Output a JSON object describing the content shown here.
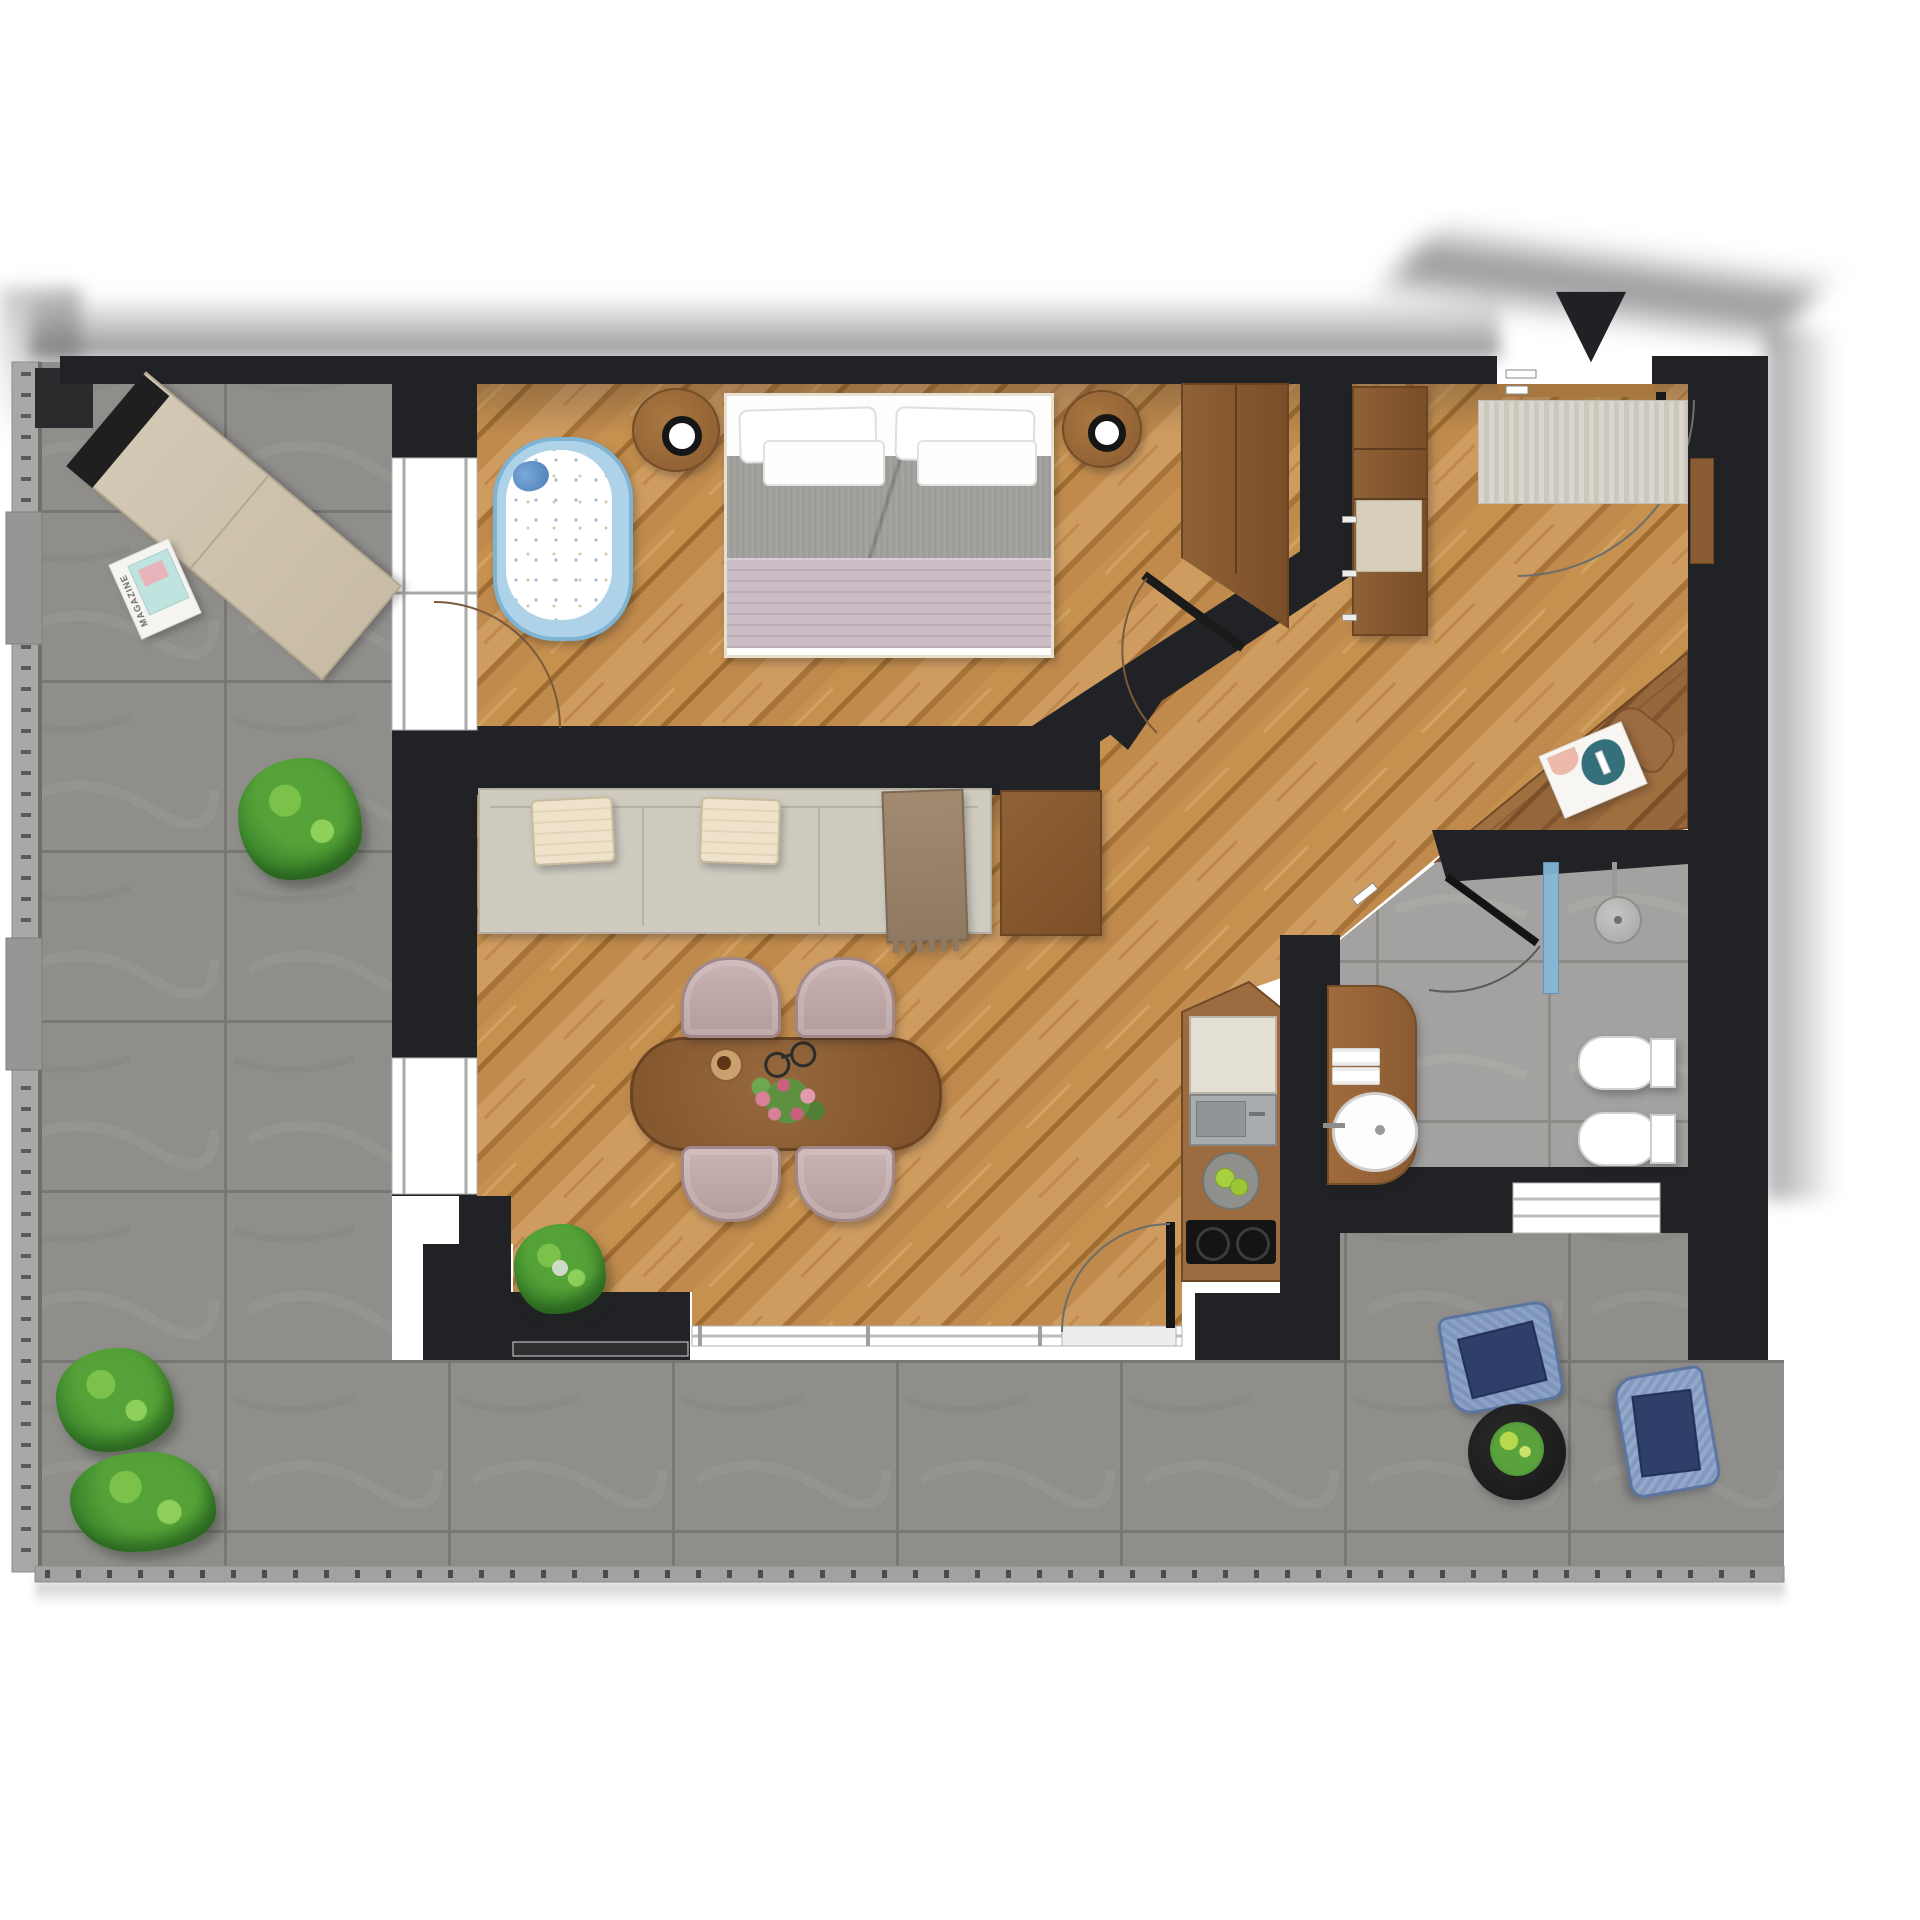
{
  "meta": {
    "title": "Apartment floor plan – photoreal top-down render",
    "view": "plan view, furnished one-bedroom apartment with wrap-around terrace"
  },
  "compass": {
    "glyph": "▼",
    "points": "down"
  },
  "palette": {
    "background": "#ffffff",
    "wall": "#212226",
    "wood_floor_light": "#cf9c60",
    "wood_floor_mid": "#c08a4c",
    "wood_dark_furniture": "#8a5c33",
    "terrace_tile": "#8f8e8b",
    "bathroom_tile": "#a1a09e",
    "sofa_fabric": "#cfcbc0",
    "bed_duvet": "#9b9b97",
    "bed_blanket_mauve": "#c7b9c2",
    "crib_blue": "#aed3e9",
    "dining_chair_mauve": "#c4adad",
    "terrace_chair_blue": "#7e95bb",
    "terrace_cushion_navy": "#2e4069",
    "shower_glass_blue": "#8cbbd9",
    "plant_green": "#3f8a2e"
  },
  "terrace": {
    "lounger_magazine_label": "MAGAZINE",
    "furniture": [
      "sun-lounger",
      "lounger-magazine",
      "potted-bush-upper",
      "bush-lower-1",
      "bush-lower-2",
      "woven-chair-1",
      "woven-chair-2",
      "black-coffee-table",
      "table-plant"
    ]
  },
  "rooms": [
    {
      "id": "bedroom",
      "furniture": [
        "double-bed",
        "pillows-x4",
        "gray-duvet",
        "striped-blanket",
        "baby-crib",
        "plush-toy",
        "nightstand-left",
        "nightstand-right",
        "wardrobe"
      ]
    },
    {
      "id": "living-dining",
      "furniture": [
        "sofa",
        "cushions-x2",
        "throw-blanket",
        "side-cabinet",
        "oval-dining-table",
        "dining-chairs-x4",
        "coffee-cup",
        "eyeglasses",
        "flower-centerpiece",
        "houseplant"
      ]
    },
    {
      "id": "kitchenette",
      "furniture": [
        "tall-fridge-unit",
        "inset-sink",
        "fruit-plate",
        "two-burner-cooktop"
      ]
    },
    {
      "id": "hallway",
      "furniture": [
        "entry-doormat",
        "hall-cabinet-column",
        "cabinet-mat",
        "corner-desk",
        "desk-chair",
        "desk-magazine",
        "recessed-cabinet"
      ]
    },
    {
      "id": "bathroom",
      "furniture": [
        "shower-glass-panel",
        "shower-head",
        "vanity-counter",
        "towels-x2",
        "round-washbasin",
        "toilet",
        "bidet"
      ]
    }
  ],
  "counts": {
    "dining_chairs": 4,
    "terrace_chairs": 2,
    "bushes": 3,
    "door_arcs": 6
  }
}
